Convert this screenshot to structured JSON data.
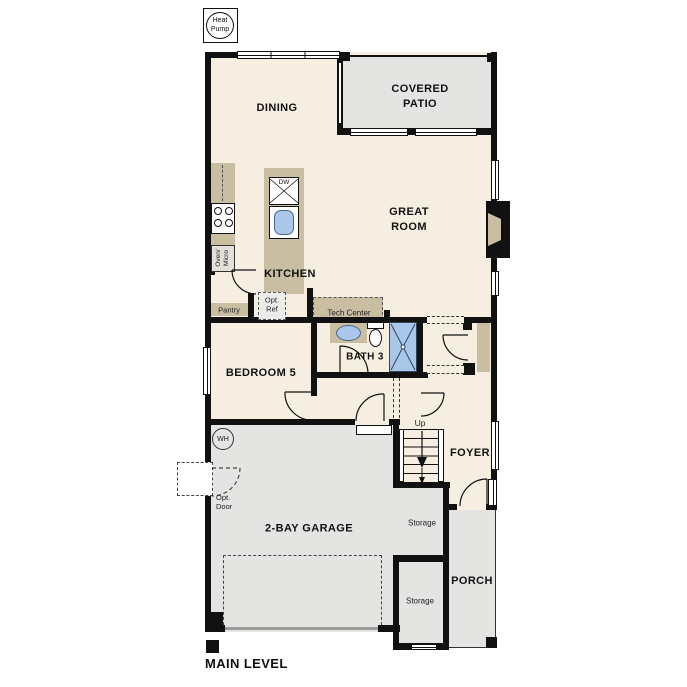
{
  "plan": {
    "title": "MAIN LEVEL",
    "heat_pump": {
      "line1": "Heat",
      "line2": "Pump"
    },
    "rooms": {
      "dining": "DINING",
      "covered_patio": "COVERED PATIO",
      "great_room": "GREAT ROOM",
      "kitchen": "KITCHEN",
      "bedroom_5": "BEDROOM 5",
      "bath_3": "BATH 3",
      "foyer": "FOYER",
      "garage": "2-BAY GARAGE",
      "porch": "PORCH",
      "storage_upper": "Storage",
      "storage_lower": "Storage"
    },
    "features": {
      "pantry": "Pantry",
      "opt_ref": "Opt.\nRef",
      "tech_center": "Tech Center",
      "oven_micro": "Oven/\nMicro",
      "dishwasher": "DW",
      "water_heater": "WH",
      "stairs_up": "Up",
      "opt_door": "Opt.\nDoor"
    },
    "colors": {
      "floor": "#f6efe1",
      "outdoor": "#e4e4e2",
      "cabinet": "#c9bda2",
      "fixture_blue": "#a9c8e9",
      "wall": "#111111"
    }
  }
}
